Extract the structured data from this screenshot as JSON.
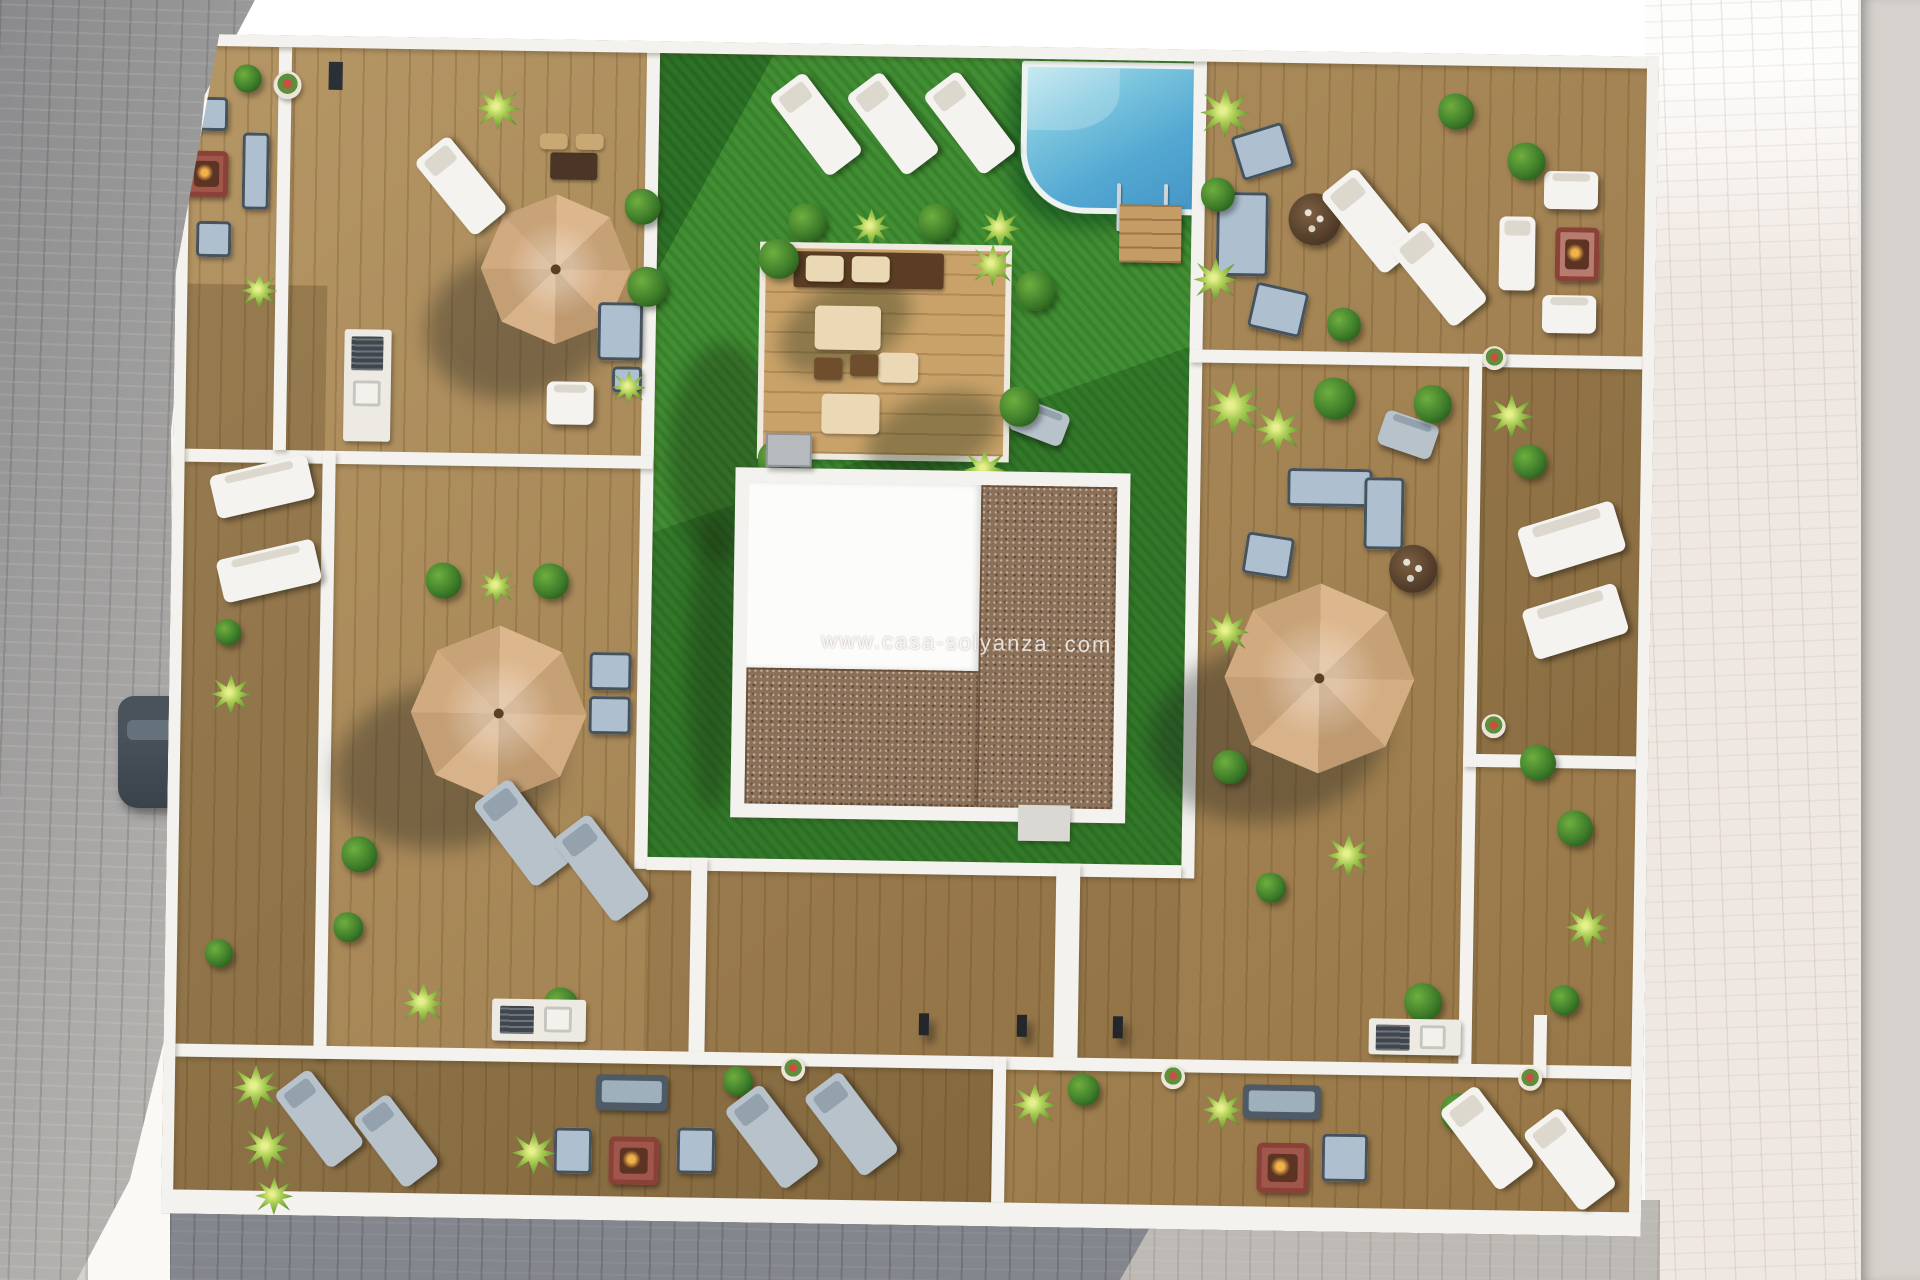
{
  "watermark": {
    "text": "www.casa-solyanza .com"
  },
  "palette": {
    "sun_pavement": "#faf9f6",
    "gray_pavers": "#b3b1ae",
    "shadow_pavers": "#84868e",
    "pink_pavers": "#efe8e2",
    "road": "#d5d1cc",
    "deck_wood": "#a5834f",
    "pergola_wood": "#c9a269",
    "wall_white": "#f3f2ee",
    "lawn_green": "#3c8a2e",
    "pool_water": "#53a8d2",
    "pool_rim": "#eef2f1",
    "gravel_roof": "#8b7057",
    "roof_white": "#fcfcfa",
    "umbrella_tan": "#d2ab83",
    "lounger_white": "#f4f3ef",
    "cushion_gray": "#aebfcf",
    "frame_dark": "#46525c",
    "fire_table": "#a0564a",
    "bush_green": "#3e7d2a",
    "palm_green": "#a7cc52",
    "car_body": "#3a424b"
  },
  "scene": {
    "type": "3d-aerial-render",
    "subject": "rooftop terrace floor plan of an apartment building",
    "objects": [
      "swimming-pool",
      "pool-ladder",
      "pool-steps-deck",
      "sun-lounger",
      "parasol-umbrella",
      "outdoor-sofa",
      "armchair",
      "fire-pit-table",
      "round-coffee-table",
      "outdoor-kitchen-counter",
      "bbq-grill",
      "sink",
      "planter-pot",
      "bush",
      "palm-plant",
      "lawn",
      "wood-deck-terrace",
      "pergola-deck",
      "gravel-roof",
      "white-roof",
      "parapet-wall",
      "walkway",
      "bollard-lamp",
      "utility-box",
      "parked-car",
      "sidewalk-pavers",
      "road"
    ]
  }
}
